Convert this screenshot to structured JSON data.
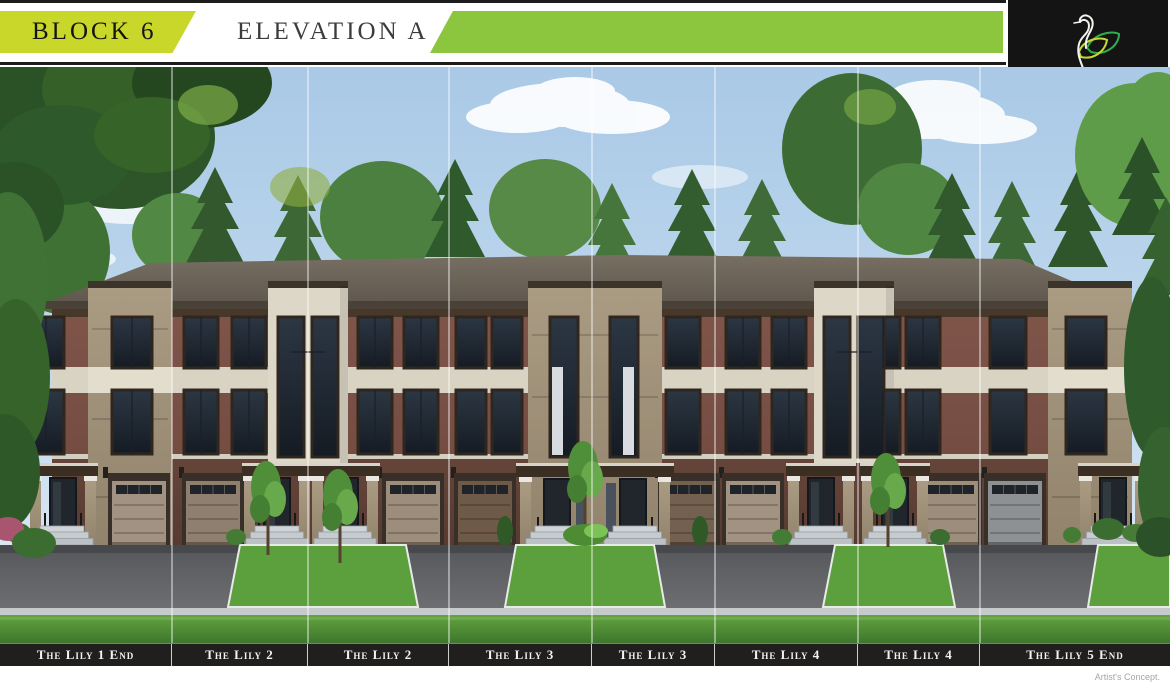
{
  "header": {
    "block_label": "BLOCK 6",
    "elevation_label": "ELEVATION A"
  },
  "logo": {
    "name": "UPLANDS",
    "tagline_prefix": "of",
    "tagline": "SWAN LAKE",
    "icon": "swan-leaf-logo"
  },
  "units": [
    {
      "label": "The Lily 1 End"
    },
    {
      "label": "The Lily 2"
    },
    {
      "label": "The Lily 2"
    },
    {
      "label": "The Lily 3"
    },
    {
      "label": "The Lily 3"
    },
    {
      "label": "The Lily 4"
    },
    {
      "label": "The Lily 4"
    },
    {
      "label": "The Lily 5 End"
    }
  ],
  "rendering": {
    "description": "Front elevation artist rendering of an eight-unit three-storey brick townhome block with garages, entry porches, trees and lawn"
  },
  "footer": {
    "note": "Artist's Concept."
  },
  "colors": {
    "accent_yellow": "#c9d62a",
    "accent_green": "#8cc63e",
    "label_bar_bg": "#211e1e",
    "logo_bg": "#141414",
    "sky_blue": "#a9c9e6",
    "brick": "#7a5044",
    "stone": "#a3937b",
    "stucco_cream": "#ddd7c7",
    "roof_gray": "#6d6459"
  }
}
